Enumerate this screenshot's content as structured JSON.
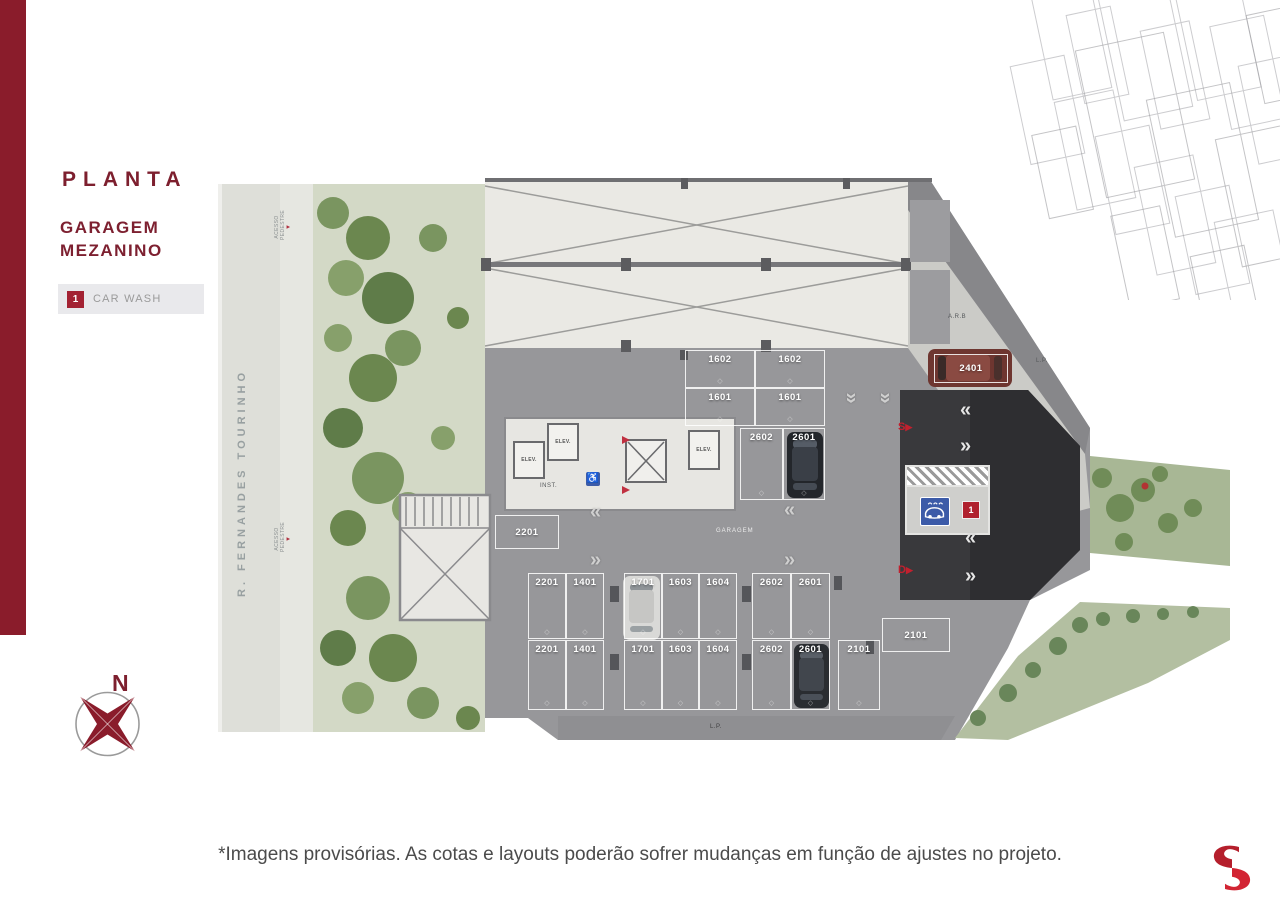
{
  "header": {
    "title": "PLANTA",
    "subtitle_1": "GARAGEM",
    "subtitle_2": "MEZANINO"
  },
  "legend": {
    "number": "1",
    "label": "CAR WASH"
  },
  "compass": {
    "north": "N"
  },
  "footer": {
    "disclaimer": "*Imagens provisórias. As cotas e layouts poderão sofrer mudanças em função de ajustes no projeto."
  },
  "colors": {
    "brand_red": "#8a1c2b",
    "accent_red": "#b0212e",
    "logo_red": "#d22433",
    "floor_gray": "#97979a",
    "ramp_dark": "#39393c"
  },
  "plan": {
    "street_label": "R. FERNANDES TOURINHO",
    "access_label": "ACESSO PEDESTRE",
    "garage_label": "GARAGEM",
    "area_label": "A.R.B",
    "property_line_right": "L.P.",
    "property_line_bottom": "L.P.",
    "elevator_label": "ELEV.",
    "inst_label": "INST.",
    "ramp_up": "S",
    "ramp_down": "D",
    "carwash_number": "1",
    "upper_block": [
      "1602",
      "1602",
      "1601",
      "1601"
    ],
    "upper_pair": [
      "2602",
      "2601"
    ],
    "spot_2401": "2401",
    "spot_2201": "2201",
    "row1": [
      "2201",
      "1401",
      "1701",
      "1603",
      "1604",
      "2602",
      "2601"
    ],
    "row2": [
      "2201",
      "1401",
      "1701",
      "1603",
      "1604",
      "2602",
      "2601",
      "2101"
    ],
    "spot_2101_h": "2101"
  }
}
